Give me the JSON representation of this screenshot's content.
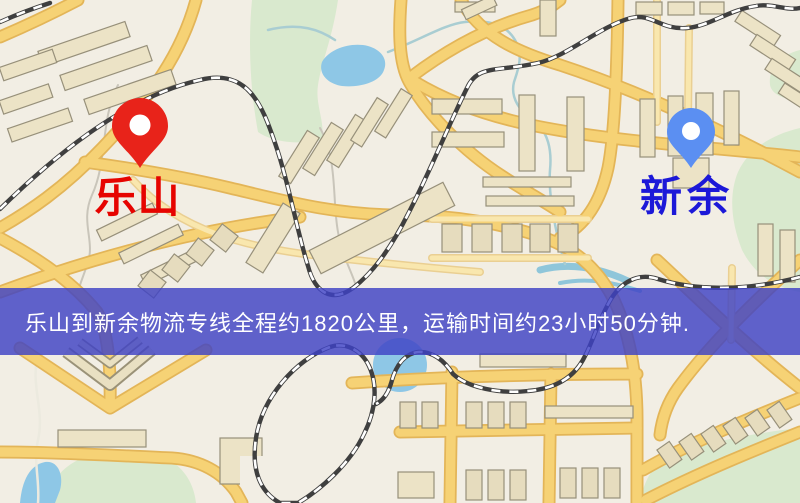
{
  "map_view": {
    "origin": {
      "label": "乐山",
      "pin_color": "#e8231a",
      "label_color": "#e60400"
    },
    "destination": {
      "label": "新余",
      "pin_color": "#5b8ff2",
      "label_color": "#1c18d8"
    },
    "route_banner": {
      "text": "乐山到新余物流专线全程约1820公里，运输时间约23小时50分钟.",
      "background_color": "rgba(62,66,196,0.82)",
      "text_color": "#ffffff"
    },
    "palette": {
      "background": "#f2eee4",
      "road_fill": "#f6d275",
      "road_casing": "#e3b558",
      "park": "#d9e9ce",
      "water": "#8ec7e6",
      "building": "#ece3c6",
      "railway": "#3f3f3f"
    }
  }
}
